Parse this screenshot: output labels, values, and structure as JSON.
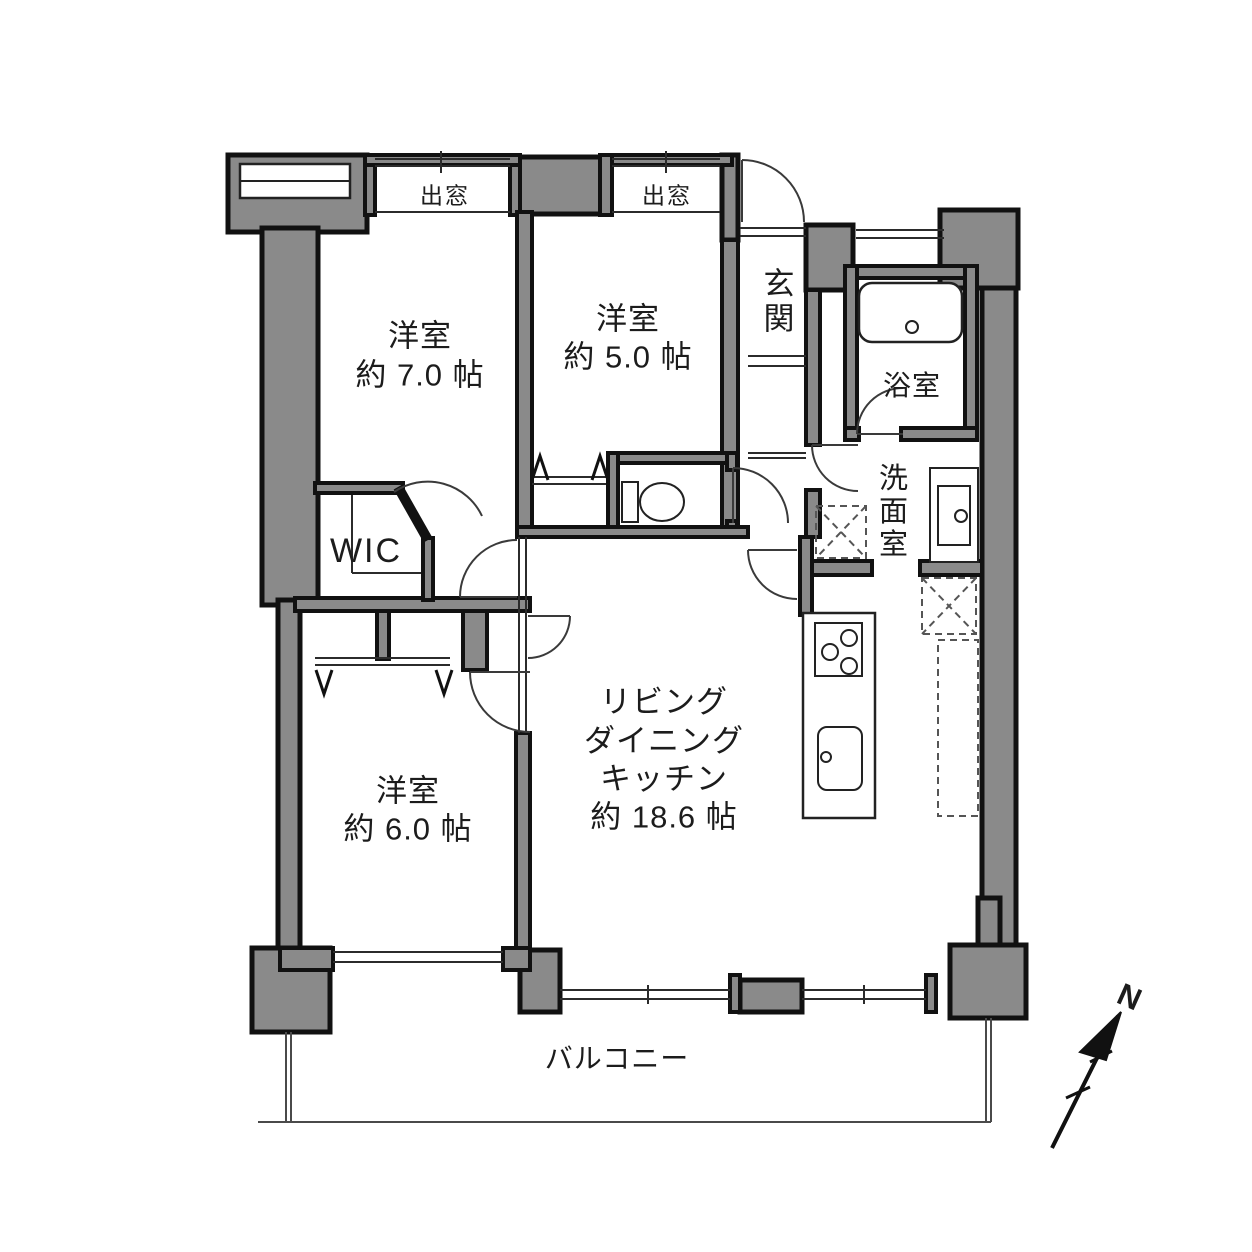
{
  "rooms": {
    "bedroom1": {
      "label": "洋室",
      "area": "約 7.0 帖"
    },
    "bedroom2": {
      "label": "洋室",
      "area": "約 5.0 帖"
    },
    "bedroom3": {
      "label": "洋室",
      "area": "約 6.0 帖"
    },
    "ldk": {
      "line1": "リビング",
      "line2": "ダイニング",
      "line3": "キッチン",
      "area": "約 18.6 帖"
    },
    "wic": {
      "label": "WIC"
    },
    "entrance": {
      "label": "玄関"
    },
    "bathroom": {
      "label": "浴室"
    },
    "washroom": {
      "label": "洗面室"
    }
  },
  "features": {
    "bay_window_left": "出窓",
    "bay_window_right": "出窓",
    "balcony": "バルコニー"
  },
  "compass": {
    "north": "N"
  },
  "colors": {
    "wall_gray": "#8a8a8a",
    "line_black": "#1a1a1a",
    "background": "#ffffff"
  }
}
